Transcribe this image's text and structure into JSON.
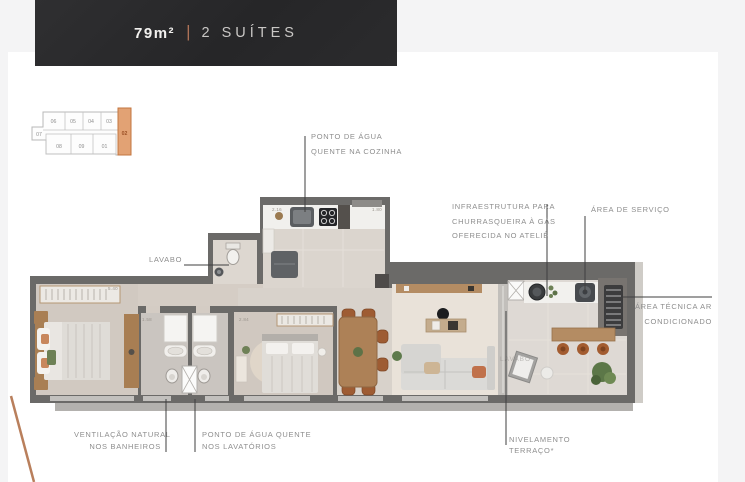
{
  "banner": {
    "area": "79m²",
    "divider": "|",
    "suites": "2 SUÍTES",
    "background": "#2a2a2c",
    "divider_color": "#ad7257"
  },
  "key_plan": {
    "units": [
      "06",
      "05",
      "04",
      "03",
      "07",
      "08",
      "09",
      "01"
    ],
    "highlighted_unit": "02",
    "highlight_color": "#e2a274",
    "highlight_border": "#c3763f"
  },
  "callouts": {
    "agua_cozinha": {
      "lines": [
        "PONTO DE ÁGUA",
        "QUENTE NA COZINHA"
      ]
    },
    "lavabo": {
      "label": "LAVABO"
    },
    "churrasqueira": {
      "lines": [
        "INFRAESTRUTURA PARA",
        "CHURRASQUEIRA À GÁS",
        "OFERECIDA NO ATELIÊ"
      ]
    },
    "area_servico": {
      "label": "ÁREA DE SERVIÇO"
    },
    "area_tecnica_ar": {
      "lines": [
        "ÁREA TÉCNICA AR",
        "CONDICIONADO"
      ]
    },
    "ventilacao": {
      "lines": [
        "VENTILAÇÃO NATURAL",
        "NOS BANHEIROS"
      ]
    },
    "agua_lavatorios": {
      "lines": [
        "PONTO DE ÁGUA QUENTE",
        "NOS LAVATÓRIOS"
      ]
    },
    "nivelamento": {
      "lines": [
        "NIVELAMENTO",
        "TERRAÇO*"
      ]
    }
  },
  "plan": {
    "dimensions": [
      "5.40",
      "2.16",
      "1.80",
      "1.58",
      "2.84"
    ],
    "floor_text": "LAVABO",
    "wall_color": "#6b6a68",
    "floor_color": "#d3cbc3",
    "living_floor_color": "#e9e2d9",
    "wood_color": "#ad8157",
    "accent_terracotta": "#c0714b",
    "decorative_line_color": "#b97f5c"
  }
}
